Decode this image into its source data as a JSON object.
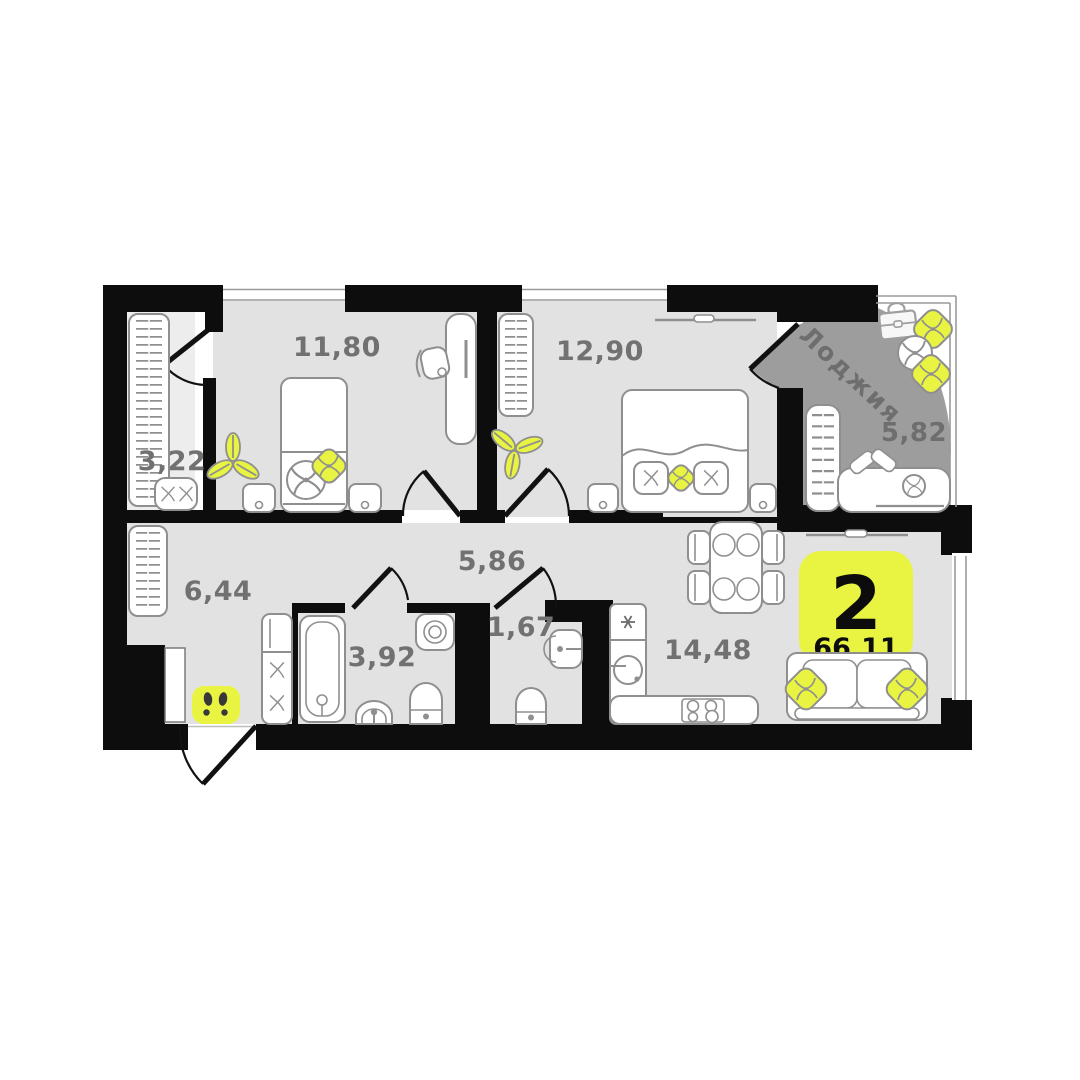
{
  "plan": {
    "type": "apartment-floor-plan",
    "badge": {
      "rooms_count": "2",
      "total_area": "66,11"
    },
    "rooms": {
      "closet": {
        "area": "3,22"
      },
      "bedroom1": {
        "area": "11,80"
      },
      "bedroom2": {
        "area": "12,90"
      },
      "loggia": {
        "name": "Лоджия",
        "area": "5,82"
      },
      "hallway": {
        "area": "6,44"
      },
      "corridor": {
        "area": "5,86"
      },
      "bathroom": {
        "area": "3,92"
      },
      "wc": {
        "area": "1,67"
      },
      "kitchen_living": {
        "area": "14,48"
      }
    },
    "colors": {
      "accent_yellow": "#e9f442",
      "floor": "#e2e2e2",
      "floor_light": "#ededed",
      "loggia_floor": "#9d9d9d",
      "wall": "#0d0d0d",
      "outline_gray": "#8f8f8f",
      "label_gray": "#717171"
    }
  }
}
